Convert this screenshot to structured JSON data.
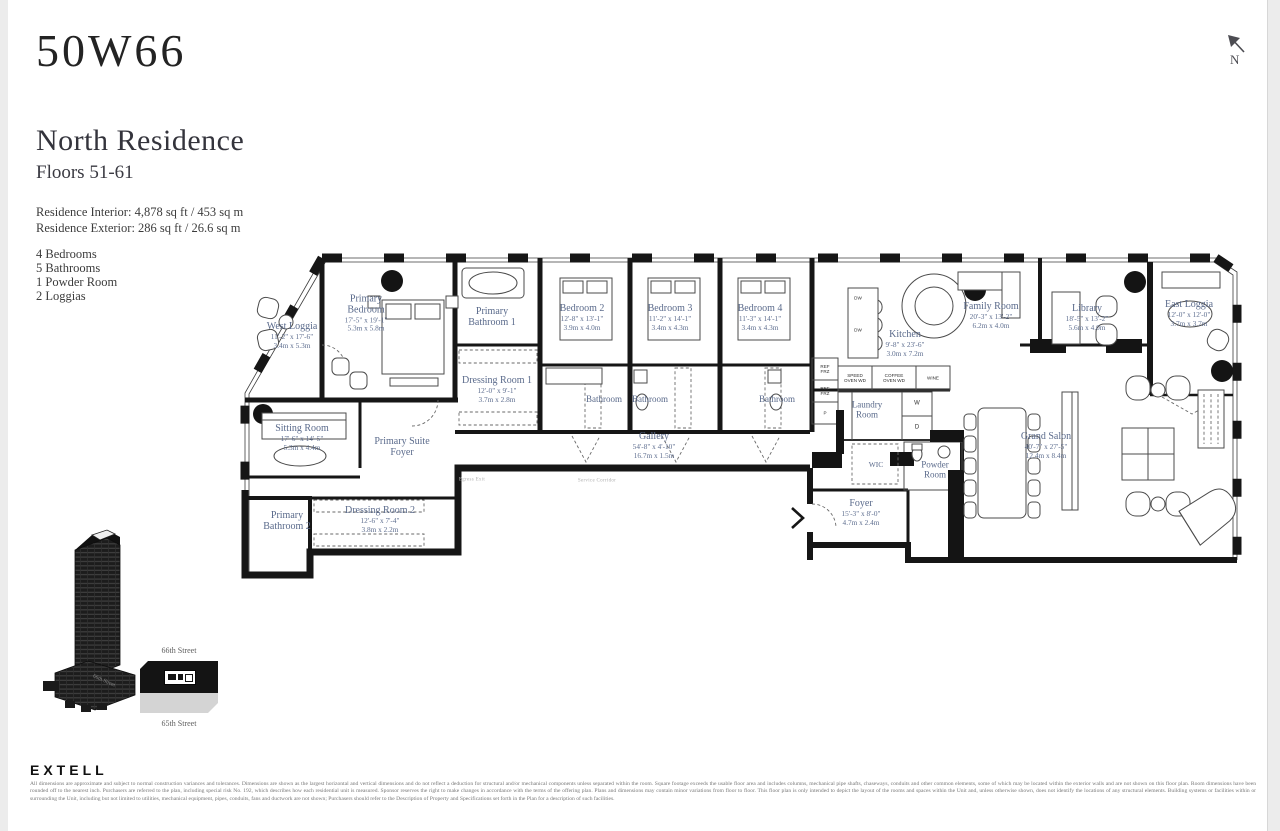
{
  "header": {
    "logo": "50W66",
    "title": "North Residence",
    "floors": "Floors 51-61",
    "interior": "Residence Interior: 4,878 sq ft / 453 sq m",
    "exterior": "Residence Exterior: 286 sq ft / 26.6 sq m",
    "features": [
      "4 Bedrooms",
      "5 Bathrooms",
      "1 Powder Room",
      "2 Loggias"
    ]
  },
  "north_indicator": {
    "label": "N"
  },
  "floorplan": {
    "rooms": [
      {
        "name": "West Loggia",
        "dims_ft": "11'-2\" x 17'-6\"",
        "dims_m": "3.4m x 5.3m"
      },
      {
        "name": "Primary Bedroom",
        "dims_ft": "17'-5\" x 19'-1\"",
        "dims_m": "5.3m x 5.8m"
      },
      {
        "name": "Primary Bathroom 1"
      },
      {
        "name": "Dressing Room 1",
        "dims_ft": "12'-0\" x 9'-1\"",
        "dims_m": "3.7m x 2.8m"
      },
      {
        "name": "Sitting Room",
        "dims_ft": "17'-6\" x 14'-5\"",
        "dims_m": "5.3m x 4.4m"
      },
      {
        "name": "Primary Suite Foyer"
      },
      {
        "name": "Primary Bathroom 2"
      },
      {
        "name": "Dressing Room 2",
        "dims_ft": "12'-6\" x 7'-4\"",
        "dims_m": "3.8m x 2.2m"
      },
      {
        "name": "Bedroom 2",
        "dims_ft": "12'-8\" x 13'-1\"",
        "dims_m": "3.9m x 4.0m"
      },
      {
        "name": "Bedroom 3",
        "dims_ft": "11'-2\" x 14'-1\"",
        "dims_m": "3.4m x 4.3m"
      },
      {
        "name": "Bedroom 4",
        "dims_ft": "11'-3\" x 14'-1\"",
        "dims_m": "3.4m x 4.3m"
      },
      {
        "name": "Bathroom"
      },
      {
        "name": "Bathroom"
      },
      {
        "name": "Bathroom"
      },
      {
        "name": "Gallery",
        "dims_ft": "54'-8\" x 4'-10\"",
        "dims_m": "16.7m x 1.5m"
      },
      {
        "name": "Kitchen",
        "dims_ft": "9'-8\" x 23'-6\"",
        "dims_m": "3.0m x 7.2m"
      },
      {
        "name": "Family Room",
        "dims_ft": "20'-3\" x 13'-2\"",
        "dims_m": "6.2m x 4.0m"
      },
      {
        "name": "Library",
        "dims_ft": "18'-5\" x 13'-2\"",
        "dims_m": "5.6m x 4.0m"
      },
      {
        "name": "East Loggia",
        "dims_ft": "12'-0\" x 12'-0\"",
        "dims_m": "3.7m x 3.7m"
      },
      {
        "name": "Laundry Room"
      },
      {
        "name": "WIC"
      },
      {
        "name": "Powder Room"
      },
      {
        "name": "Foyer",
        "dims_ft": "15'-3\" x 8'-0\"",
        "dims_m": "4.7m x 2.4m"
      },
      {
        "name": "Grand Salon",
        "dims_ft": "40'-7\" x 27'-5\"",
        "dims_m": "12.4m x 8.4m"
      }
    ],
    "fixtures": {
      "dw": "DW",
      "washer": "W",
      "dryer": "D",
      "ref": "REF FRZ",
      "pantry": "P",
      "speed_oven": "SPEED OVEN WD",
      "coffee_oven": "COFFEE OVEN WD",
      "wine": "WINE"
    },
    "annotations": {
      "egress": "Egress Exit",
      "service_corridor": "Service Corridor"
    }
  },
  "keyplan": {
    "north_street": "66th Street",
    "south_street": "65th Street",
    "tower_caption": "66th Street"
  },
  "footer": {
    "brand": "EXTELL",
    "disclaimer": "All dimensions are approximate and subject to normal construction variances and tolerances. Dimensions are shown as the largest horizontal and vertical dimensions and do not reflect a deduction for structural and/or mechanical components unless separated within the room. Square footage exceeds the usable floor area and includes columns, mechanical pipe shafts, chaseways, conduits and other common elements, some of which may be located within the exterior walls and are not shown on this floor plan. Room dimensions have been rounded off to the nearest inch. Purchasers are referred to the plan, including special risk No. 192, which describes how each residential unit is measured. Sponsor reserves the right to make changes in accordance with the terms of the offering plan. Plans and dimensions may contain minor variations from floor to floor. This floor plan is only intended to depict the layout of the rooms and spaces within the Unit and, unless otherwise shown, does not identify the locations of any structural elements. Building systems or facilities within or surrounding the Unit, including but not limited to utilities, mechanical equipment, pipes, conduits, fans and ductwork are not shown; Purchasers should refer to the Description of Property and Specifications set forth in the Plan for a description of such facilities."
  }
}
